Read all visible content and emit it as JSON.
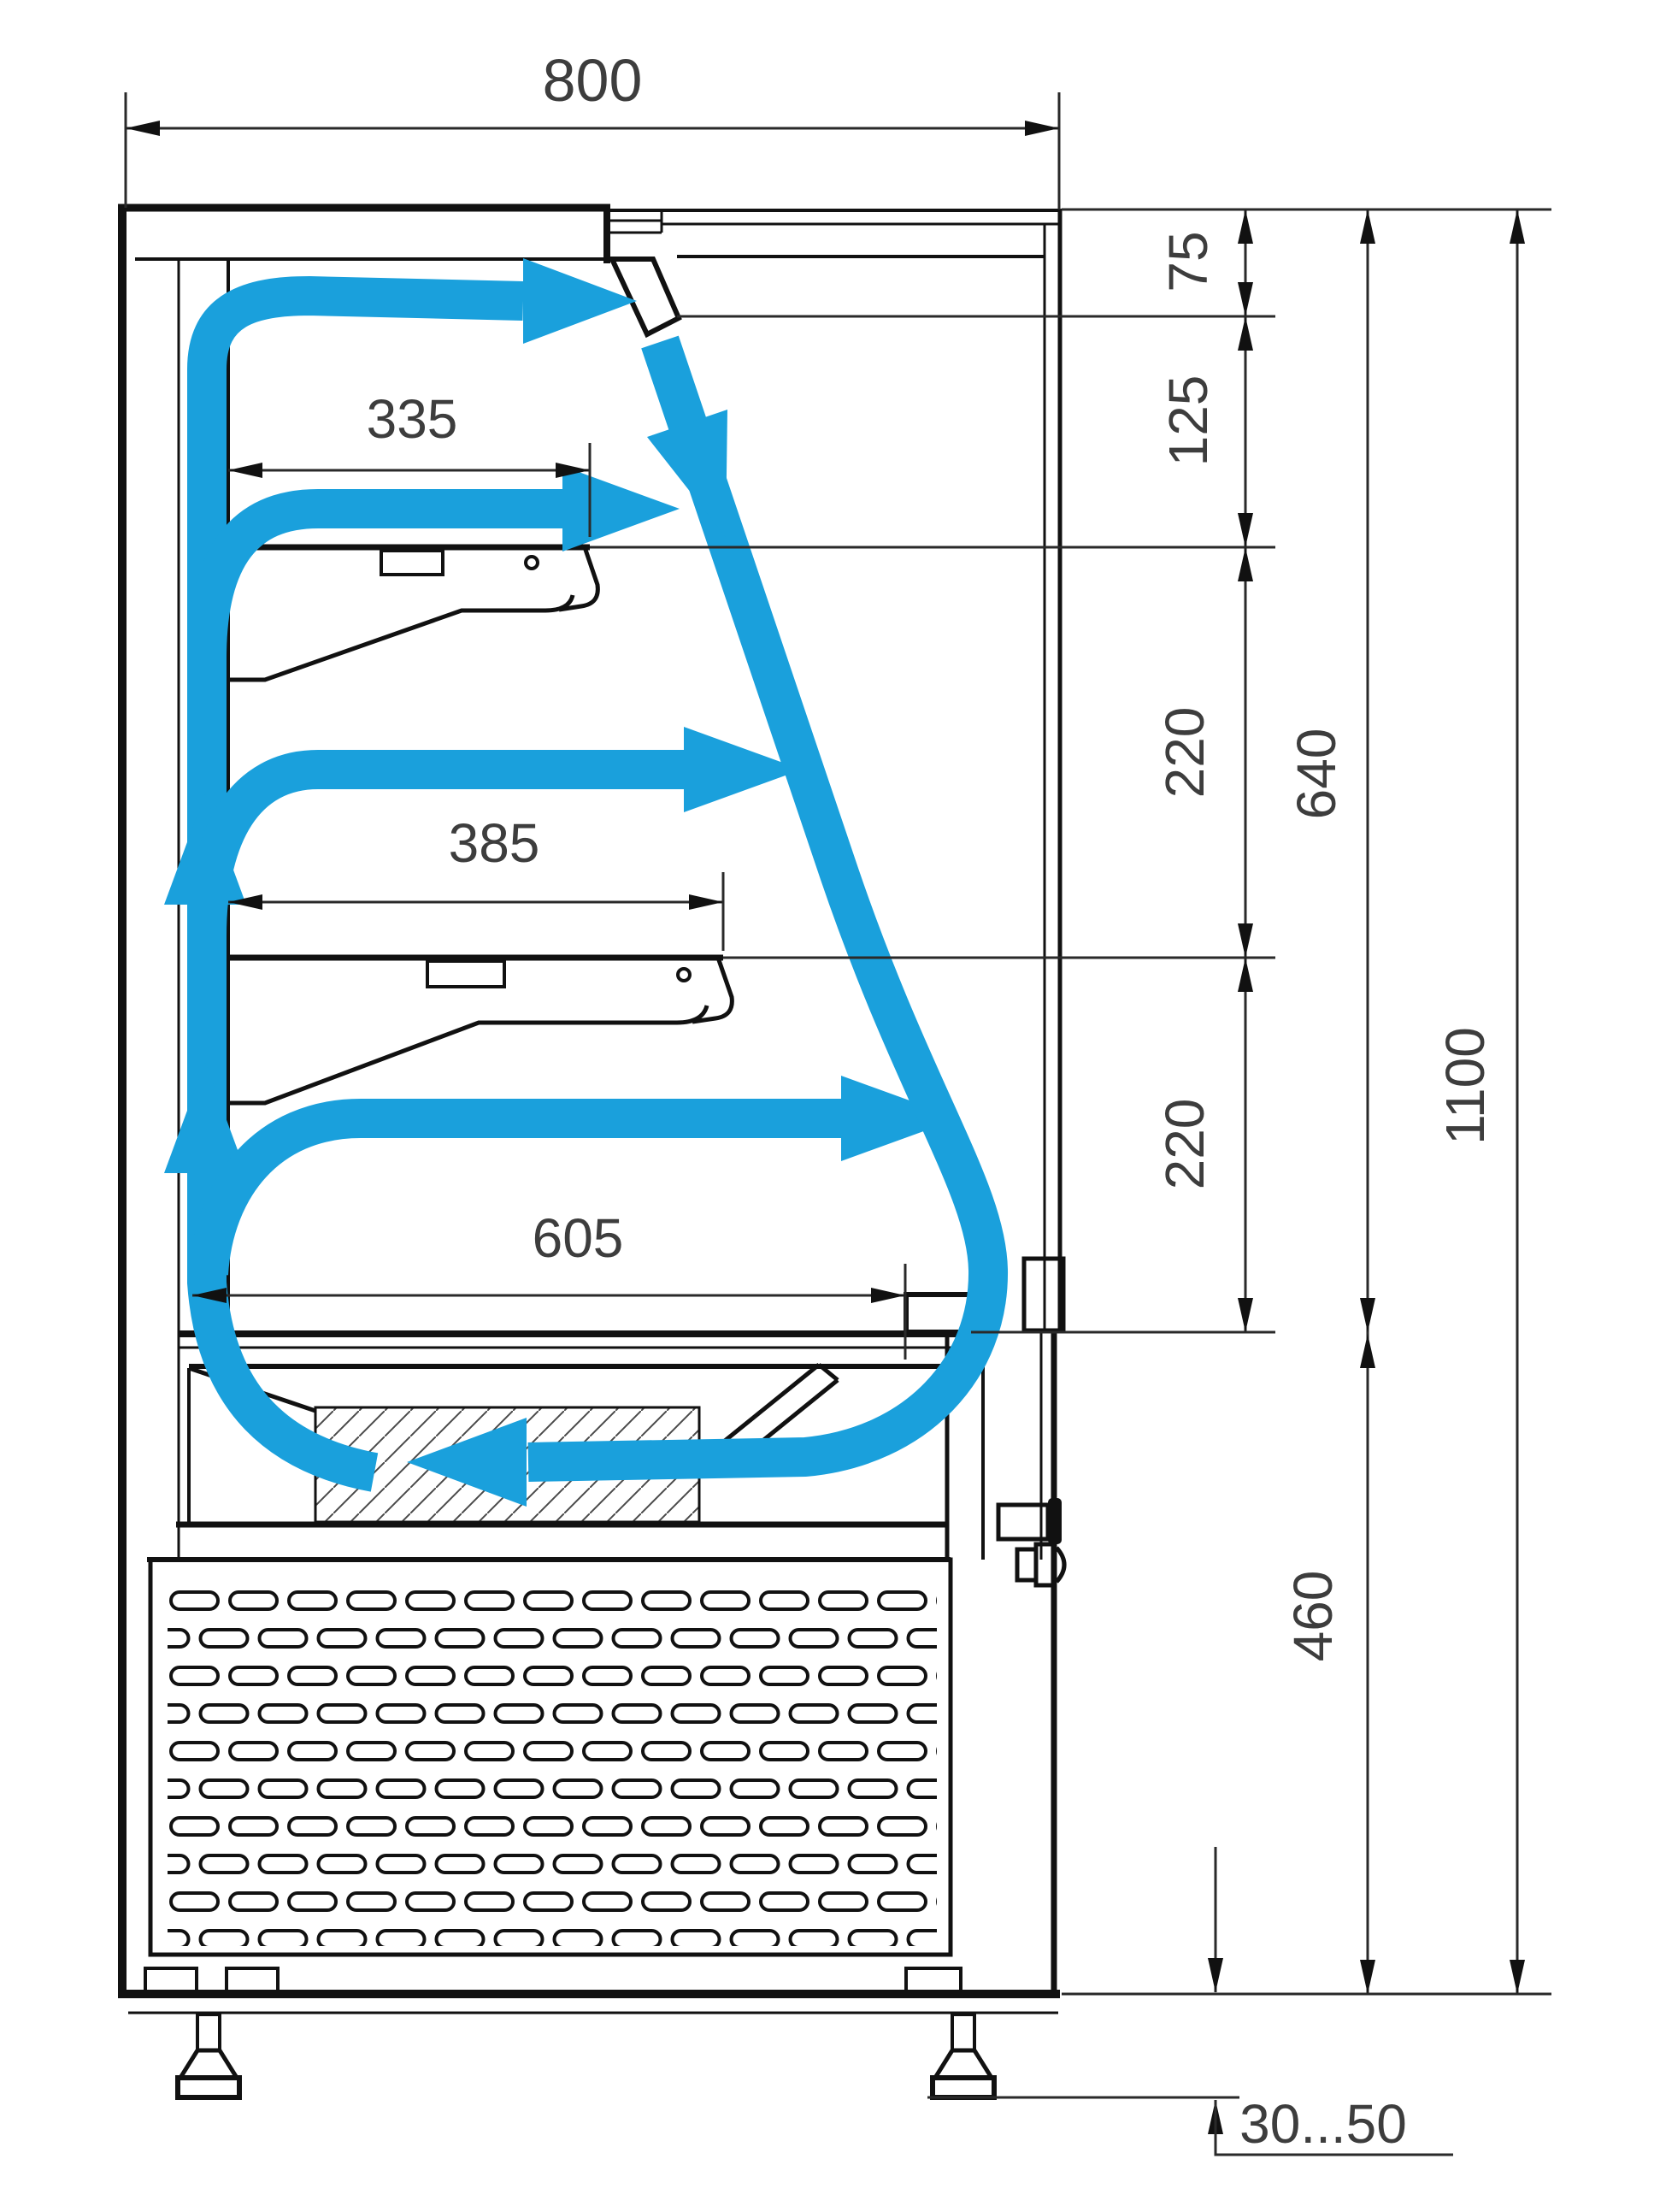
{
  "drawing": {
    "kind": "refrigerated-display-case-side-section",
    "units_note": ""
  },
  "dimensions": {
    "depth_total": "800",
    "top_to_air_outlet": "75",
    "outlet_to_shelf_1": "125",
    "shelf_1_to_shelf_2": "220",
    "shelf_2_to_deck": "220",
    "top_to_deck": "640",
    "deck_to_base": "460",
    "total_height": "1100",
    "shelf_1_depth": "335",
    "shelf_2_depth": "385",
    "deck_depth": "605",
    "leg_height_range": "30...50"
  },
  "colors": {
    "airflow": "#1aa0dc",
    "lines": "#111111",
    "dimension_text": "#3d3d3d"
  }
}
